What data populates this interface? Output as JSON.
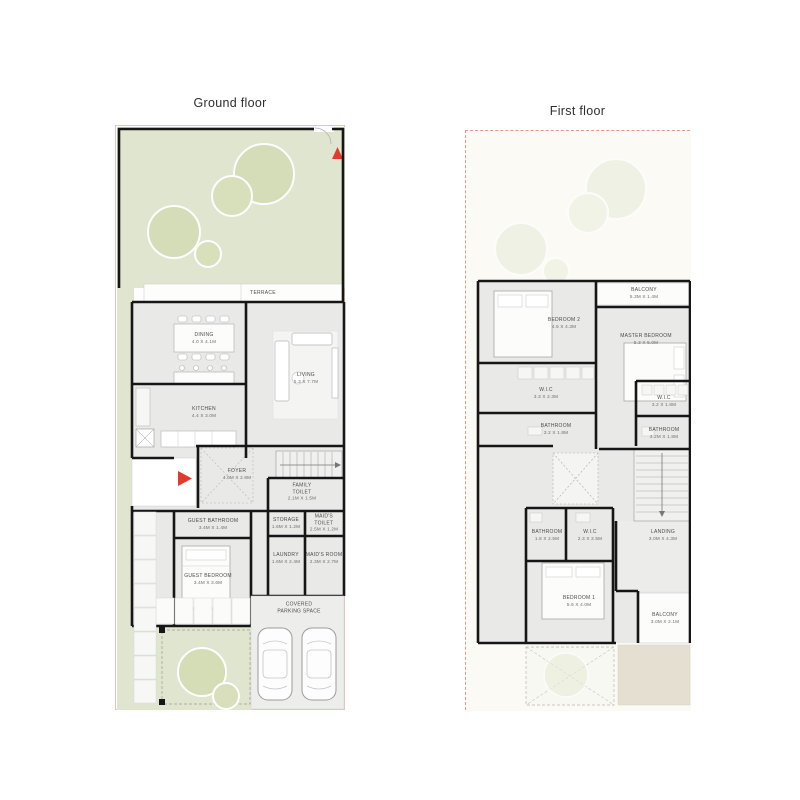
{
  "page": {
    "background": "#ffffff"
  },
  "plans": {
    "ground": {
      "title": "Ground floor",
      "rooms": {
        "terrace": {
          "name": "TERRACE",
          "dims": ""
        },
        "dining": {
          "name": "DINING",
          "dims": "4.0 X 4.1M"
        },
        "living": {
          "name": "LIVING",
          "dims": "5.3 X 7.7M"
        },
        "kitchen": {
          "name": "KITCHEN",
          "dims": "4.4 X 3.0M"
        },
        "foyer": {
          "name": "FOYER",
          "dims": "4.0M X 2.8M"
        },
        "family_toilet": {
          "name": "FAMILY TOILET",
          "dims": "2.1M X 1.5M"
        },
        "guest_bathroom": {
          "name": "GUEST BATHROOM",
          "dims": "3.4M X 1.4M"
        },
        "storage": {
          "name": "STORAGE",
          "dims": "1.6M X 1.2M"
        },
        "maids_toilet": {
          "name": "MAID'S TOILET",
          "dims": "2.5M X 1.2M"
        },
        "laundry": {
          "name": "LAUNDRY",
          "dims": "1.6M X 2.4M"
        },
        "maids_room": {
          "name": "MAID'S ROOM",
          "dims": "2.3M X 2.7M"
        },
        "guest_bedroom": {
          "name": "GUEST BEDROOM",
          "dims": "3.4M X 3.6M"
        },
        "parking": {
          "name": "COVERED PARKING SPACE",
          "dims": ""
        }
      }
    },
    "first": {
      "title": "First floor",
      "rooms": {
        "balcony_top": {
          "name": "BALCONY",
          "dims": "5.3M X 1.4M"
        },
        "bedroom2": {
          "name": "BEDROOM 2",
          "dims": "4.5 X 4.3M"
        },
        "master_bedroom": {
          "name": "MASTER BEDROOM",
          "dims": "5.3 X 5.0M"
        },
        "wic_left": {
          "name": "W.I.C",
          "dims": "3.3 X 2.3M"
        },
        "bathroom_left": {
          "name": "BATHROOM",
          "dims": "3.2 X 1.8M"
        },
        "wic_right": {
          "name": "W.I.C",
          "dims": "3.2 X 1.8M"
        },
        "bathroom_right": {
          "name": "BATHROOM",
          "dims": "3.2M X 1.8M"
        },
        "bathroom1": {
          "name": "BATHROOM",
          "dims": "1.8 X 2.5M"
        },
        "wic1": {
          "name": "W.I.C",
          "dims": "2.3 X 2.5M"
        },
        "landing": {
          "name": "LANDING",
          "dims": "3.0M X 4.3M"
        },
        "bedroom1": {
          "name": "BEDROOM 1",
          "dims": "5.6 X 4.0M"
        },
        "balcony_bottom": {
          "name": "BALCONY",
          "dims": "3.0M X 2.1M"
        }
      }
    }
  },
  "colors": {
    "garden": "#dfe5cf",
    "tree": "#d5ddb7",
    "house_fill": "#e9e9e8",
    "wall": "#161616",
    "plot_line_ground": "#eec0b6",
    "plot_line_first_dashed": "#ef948b",
    "accent_red": "#e23a2c",
    "first_floor_bg": "#fbfaf5",
    "beige_pad": "#e4dfd1",
    "parking_pad": "#ededeb"
  }
}
